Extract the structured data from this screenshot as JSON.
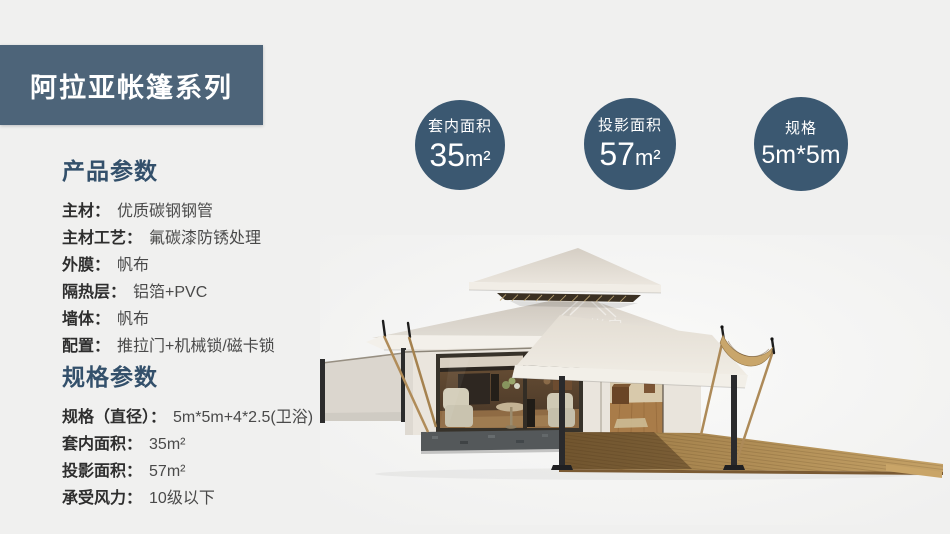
{
  "banner": {
    "title": "阿拉亚帐篷系列"
  },
  "stat_circles": [
    {
      "label": "套内面积",
      "value": "35",
      "unit": "m²"
    },
    {
      "label": "投影面积",
      "value": "57",
      "unit": "m²"
    },
    {
      "label": "规格",
      "value": "5m*5m",
      "unit": ""
    }
  ],
  "product_params": {
    "heading": "产品参数",
    "rows": [
      {
        "label": "主材：",
        "value": "优质碳钢钢管"
      },
      {
        "label": "主材工艺：",
        "value": "氟碳漆防锈处理"
      },
      {
        "label": "外膜：",
        "value": "帆布"
      },
      {
        "label": "隔热层：",
        "value": "铝箔+PVC"
      },
      {
        "label": "墙体：",
        "value": "帆布"
      },
      {
        "label": "配置：",
        "value": "推拉门+机械锁/磁卡锁"
      }
    ]
  },
  "spec_params": {
    "heading": "规格参数",
    "rows": [
      {
        "label": "规格（直径）：",
        "value": "5m*5m+4*2.5(卫浴)"
      },
      {
        "label": "套内面积：",
        "value": "35m²"
      },
      {
        "label": "投影面积：",
        "value": "57m²"
      },
      {
        "label": "承受风力：",
        "value": "10级以下"
      }
    ]
  },
  "tent_image": {
    "watermark_cn": "威利帐房",
    "watermark_en": "WELL TENT"
  },
  "colors": {
    "page_bg": "#f0f0ef",
    "banner_bg": "#4d6479",
    "circle_bg": "#3b5871",
    "heading_text": "#33506b",
    "deck_wood": "#b8945a",
    "canvas_roof": "#e5dfd6"
  }
}
